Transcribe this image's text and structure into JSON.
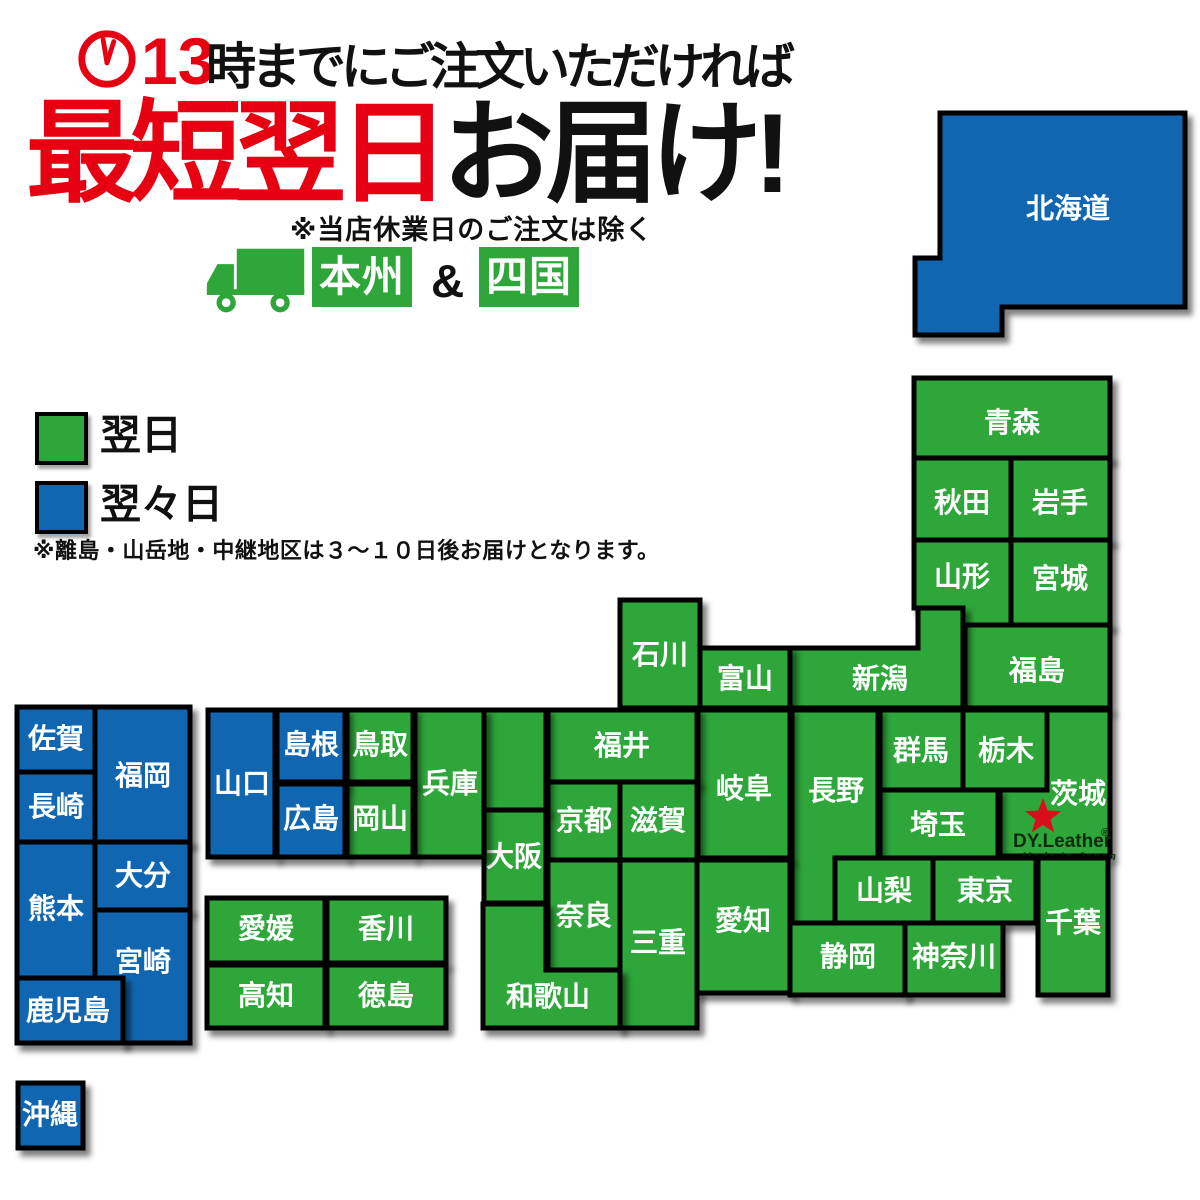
{
  "colors": {
    "green": "#2EA63A",
    "blue": "#1166B1",
    "red": "#E60012"
  },
  "header": {
    "clock_icon": "clock-icon",
    "deadline_number": "13",
    "deadline_rest": "時までにご注文いただければ",
    "headline_red": "最短翌日",
    "headline_black": "お届け!",
    "note": "※当店休業日のご注文は除く",
    "truck_icon": "delivery-truck-icon",
    "region_badge_1": "本州",
    "ampersand": "&",
    "region_badge_2": "四国"
  },
  "legend": {
    "next_day_label": "翌日",
    "two_days_label": "翌々日",
    "note": "※離島・山岳地・中継地区は３～１０日後お届けとなります。"
  },
  "logo": {
    "star_icon": "red-star-icon",
    "brand": "DY.Leather",
    "reg_mark": "®",
    "subtitle": "Made In Japan"
  },
  "map": {
    "prefectures": [
      {
        "id": "hokkaido",
        "label": "北海道",
        "delivery": "two-days"
      },
      {
        "id": "aomori",
        "label": "青森",
        "delivery": "next-day"
      },
      {
        "id": "akita",
        "label": "秋田",
        "delivery": "next-day"
      },
      {
        "id": "iwate",
        "label": "岩手",
        "delivery": "next-day"
      },
      {
        "id": "yamagata",
        "label": "山形",
        "delivery": "next-day"
      },
      {
        "id": "miyagi",
        "label": "宮城",
        "delivery": "next-day"
      },
      {
        "id": "fukushima",
        "label": "福島",
        "delivery": "next-day"
      },
      {
        "id": "niigata",
        "label": "新潟",
        "delivery": "next-day"
      },
      {
        "id": "ishikawa",
        "label": "石川",
        "delivery": "next-day"
      },
      {
        "id": "toyama",
        "label": "富山",
        "delivery": "next-day"
      },
      {
        "id": "gunma",
        "label": "群馬",
        "delivery": "next-day"
      },
      {
        "id": "tochigi",
        "label": "栃木",
        "delivery": "next-day"
      },
      {
        "id": "ibaraki",
        "label": "茨城",
        "delivery": "next-day"
      },
      {
        "id": "saitama",
        "label": "埼玉",
        "delivery": "next-day"
      },
      {
        "id": "nagano",
        "label": "長野",
        "delivery": "next-day"
      },
      {
        "id": "gifu",
        "label": "岐阜",
        "delivery": "next-day"
      },
      {
        "id": "fukui",
        "label": "福井",
        "delivery": "next-day"
      },
      {
        "id": "kyoto",
        "label": "京都",
        "delivery": "next-day"
      },
      {
        "id": "shiga",
        "label": "滋賀",
        "delivery": "next-day"
      },
      {
        "id": "kyoto-north",
        "label": "",
        "delivery": "next-day"
      },
      {
        "id": "osaka",
        "label": "大阪",
        "delivery": "next-day"
      },
      {
        "id": "nara",
        "label": "奈良",
        "delivery": "next-day"
      },
      {
        "id": "mie",
        "label": "三重",
        "delivery": "next-day"
      },
      {
        "id": "aichi",
        "label": "愛知",
        "delivery": "next-day"
      },
      {
        "id": "yamanashi",
        "label": "山梨",
        "delivery": "next-day"
      },
      {
        "id": "tokyo",
        "label": "東京",
        "delivery": "next-day"
      },
      {
        "id": "chiba",
        "label": "千葉",
        "delivery": "next-day"
      },
      {
        "id": "shizuoka",
        "label": "静岡",
        "delivery": "next-day"
      },
      {
        "id": "kanagawa",
        "label": "神奈川",
        "delivery": "next-day"
      },
      {
        "id": "wakayama",
        "label": "和歌山",
        "delivery": "next-day"
      },
      {
        "id": "hyogo",
        "label": "兵庫",
        "delivery": "next-day"
      },
      {
        "id": "tottori",
        "label": "鳥取",
        "delivery": "next-day"
      },
      {
        "id": "okayama",
        "label": "岡山",
        "delivery": "next-day"
      },
      {
        "id": "yamaguchi",
        "label": "山口",
        "delivery": "two-days"
      },
      {
        "id": "shimane",
        "label": "島根",
        "delivery": "two-days"
      },
      {
        "id": "hiroshima",
        "label": "広島",
        "delivery": "two-days"
      },
      {
        "id": "ehime",
        "label": "愛媛",
        "delivery": "next-day"
      },
      {
        "id": "kagawa",
        "label": "香川",
        "delivery": "next-day"
      },
      {
        "id": "kochi",
        "label": "高知",
        "delivery": "next-day"
      },
      {
        "id": "tokushima",
        "label": "徳島",
        "delivery": "next-day"
      },
      {
        "id": "saga",
        "label": "佐賀",
        "delivery": "two-days"
      },
      {
        "id": "nagasaki",
        "label": "長崎",
        "delivery": "two-days"
      },
      {
        "id": "fukuoka",
        "label": "福岡",
        "delivery": "two-days"
      },
      {
        "id": "kumamoto",
        "label": "熊本",
        "delivery": "two-days"
      },
      {
        "id": "oita",
        "label": "大分",
        "delivery": "two-days"
      },
      {
        "id": "miyazaki",
        "label": "宮崎",
        "delivery": "two-days"
      },
      {
        "id": "kagoshima",
        "label": "鹿児島",
        "delivery": "two-days"
      },
      {
        "id": "okinawa",
        "label": "沖縄",
        "delivery": "two-days"
      }
    ]
  }
}
